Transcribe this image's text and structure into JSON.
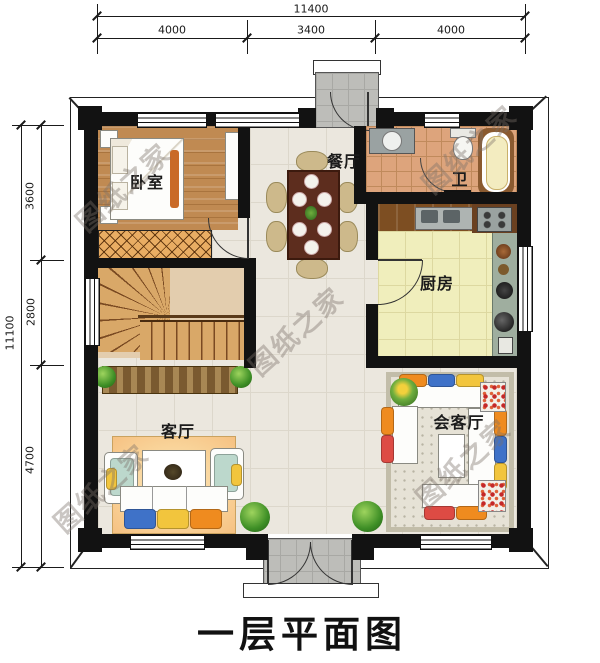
{
  "title": "一层平面图",
  "watermark": "图纸之家",
  "dimensions": {
    "top": {
      "total": "11400",
      "segments": [
        "4000",
        "3400",
        "4000"
      ]
    },
    "left": {
      "total": "11100",
      "segments": [
        "3600",
        "2800",
        "4700"
      ]
    }
  },
  "rooms": {
    "bedroom": {
      "label": "卧室"
    },
    "dining": {
      "label": "餐厅"
    },
    "bath": {
      "label": "卫"
    },
    "kitchen": {
      "label": "厨房"
    },
    "living": {
      "label": "客厅"
    },
    "reception": {
      "label": "会客厅"
    }
  },
  "colors": {
    "wall": "#121212",
    "floor_tile": "#ebe7de",
    "bedroom_wood": "#c08a52",
    "kitchen_floor": "#f0eebc",
    "bath_tile": "#dda47c",
    "stair_wood": "#d9a868",
    "living_rug": "#f6c182",
    "porch_gray": "#bdbdb9",
    "cushion_blue": "#3f72c8",
    "cushion_yellow": "#f2c53d",
    "cushion_orange": "#ef8b1f",
    "cushion_red": "#dd4b44",
    "plant_green": "#3e8f26"
  }
}
